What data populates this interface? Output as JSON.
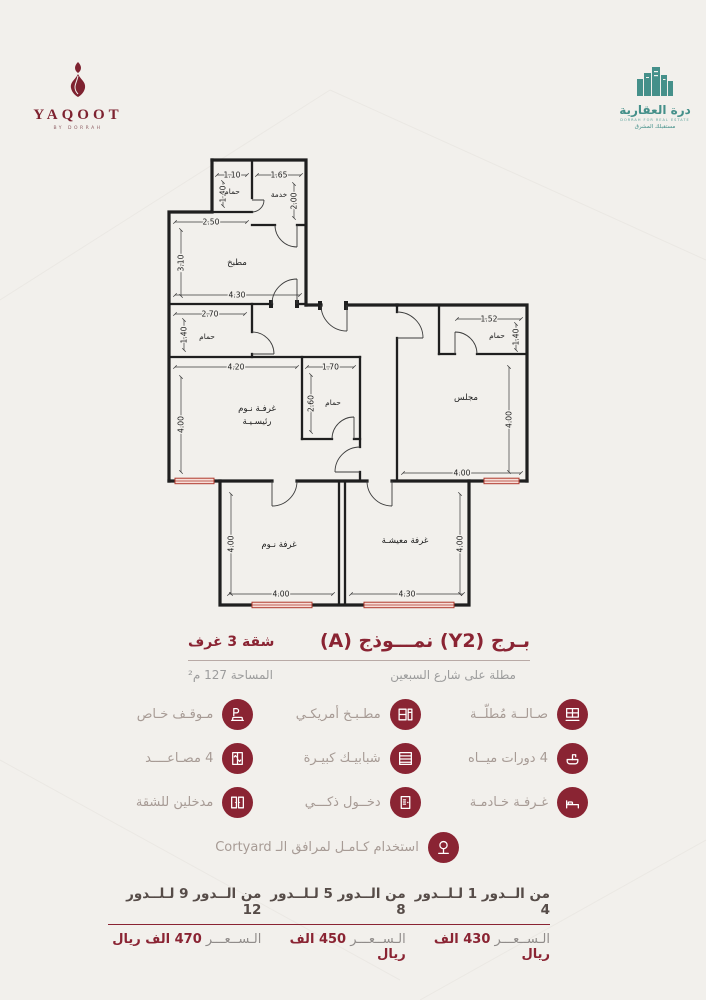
{
  "colors": {
    "maroon": "#8a2433",
    "teal": "#45908a",
    "window_red": "#b03a2e",
    "wall": "#1f1f1f"
  },
  "brand": {
    "yaqoot": {
      "name": "YAQOOT",
      "tagline": "BY DORRAH"
    },
    "dorrah": {
      "name": "درة العقارية",
      "sub_en": "DORRAH FOR REAL ESTATE",
      "sub_ar": "مستقبلك المشرق"
    }
  },
  "title": {
    "main": "بـرج (Y2) نمـــوذج (A)",
    "side": "شقة 3 غرف",
    "subtitle": "مطلة على شارع السبعين",
    "area": "المساحة 127 م²"
  },
  "plan": {
    "rooms": {
      "svc_bath": "حمام",
      "service": "خدمة",
      "kitchen": "مطبخ",
      "mid_bath": "حمام",
      "master_l1": "غرفـة نـوم",
      "master_l2": "رئيسـيـة",
      "small_bath": "حمام",
      "right_bath": "حمام",
      "majlis": "مجلس",
      "bedroom": "غرفة نـوم",
      "living": "غرفة معيشـة"
    },
    "dims": {
      "d1": "1.10",
      "d2": "1.40",
      "d3": "1.65",
      "d4": "2.00",
      "d5": "2.50",
      "d6": "3.10",
      "d7": "4.30",
      "d8": "2.70",
      "d9": "1.40",
      "d10": "4.20",
      "d11": "4.00",
      "d12": "1.70",
      "d13": "2.60",
      "d14": "1.52",
      "d15": "1.40",
      "d16": "4.00",
      "d17": "4.00",
      "d18": "4.00",
      "d19": "4.00",
      "d20": "4.30",
      "d21": "4.00"
    }
  },
  "features": {
    "items": [
      {
        "label": "صـالــة مُطلّــة",
        "icon": "hall-view"
      },
      {
        "label": "مطـبـخ أمريكـي",
        "icon": "kitchen"
      },
      {
        "label": "مـوقـف خـاص",
        "icon": "parking"
      },
      {
        "label": "4 دورات ميــاه",
        "icon": "bathrooms"
      },
      {
        "label": "شبابيـك كبيـرة",
        "icon": "big-windows"
      },
      {
        "label": "4 مصـاعــــد",
        "icon": "elevators"
      },
      {
        "label": "غـرفـة خـادمـة",
        "icon": "maid-room"
      },
      {
        "label": "دخــول ذكـــي",
        "icon": "smart-entry"
      },
      {
        "label": "مدخلين للشقة",
        "icon": "two-entrances"
      }
    ],
    "courtyard": {
      "label": "استخدام كـامـل لمرافق الـ Cortyard",
      "icon": "courtyard"
    }
  },
  "pricing": {
    "tiers": [
      {
        "range": "من الــدور 1 لـلــدور 4",
        "price_label": "الـســعـــر",
        "price_value": "430 الف ريال"
      },
      {
        "range": "من الــدور 5 لـلــدور 8",
        "price_label": "الـســعـــر",
        "price_value": "450 الف ريال"
      },
      {
        "range": "من الــدور 9 لـلــدور 12",
        "price_label": "الـســعـــر",
        "price_value": "470 الف ريال"
      }
    ]
  }
}
